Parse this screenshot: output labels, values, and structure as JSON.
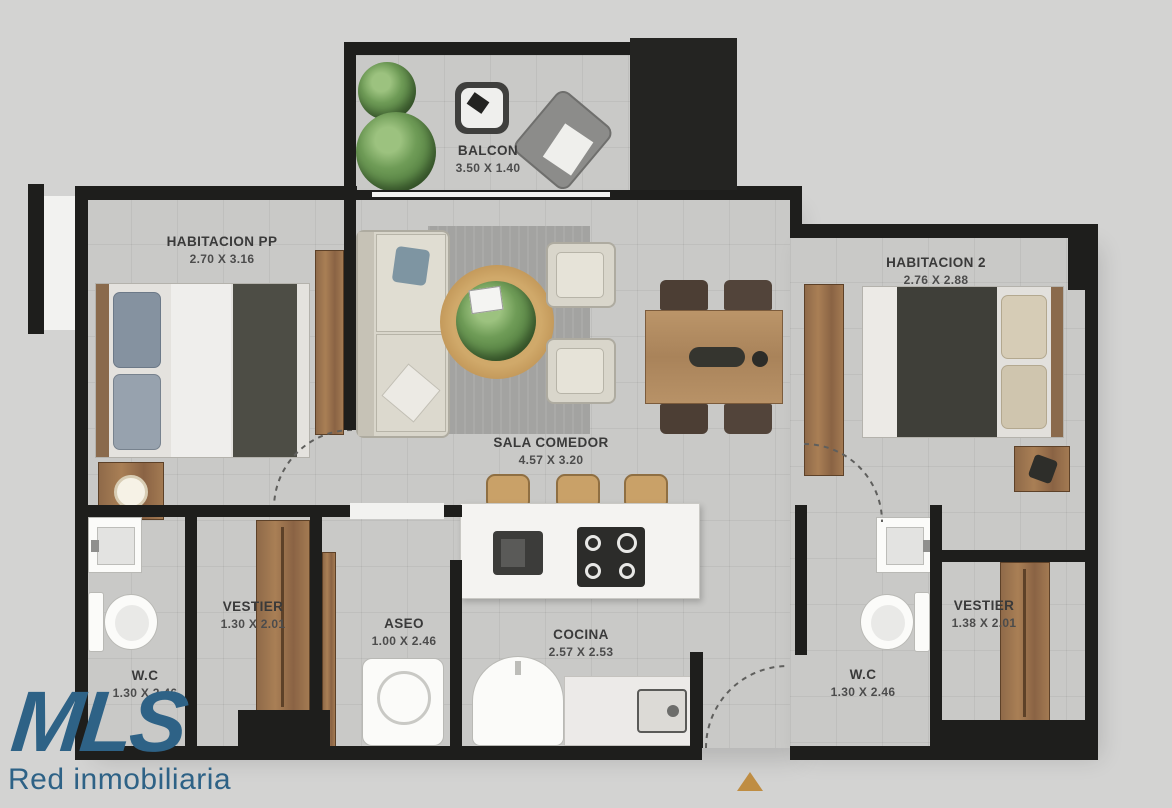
{
  "background": "#d3d3d2",
  "plan": {
    "wall_color": "#1e1e1c",
    "floor_color": "#c9c9c7",
    "accent_wood_color": "#a97f55",
    "rooms": [
      {
        "name": "BALCON",
        "dims": "3.50 X 1.40"
      },
      {
        "name": "HABITACION PP",
        "dims": "2.70 X 3.16"
      },
      {
        "name": "HABITACION 2",
        "dims": "2.76 X 2.88"
      },
      {
        "name": "SALA COMEDOR",
        "dims": "4.57 X 3.20"
      },
      {
        "name": "VESTIER",
        "dims": "1.30 X 2.01"
      },
      {
        "name": "ASEO",
        "dims": "1.00 X 2.46"
      },
      {
        "name": "COCINA",
        "dims": "2.57 X 2.53"
      },
      {
        "name": "W.C",
        "dims": "1.30 X 2.46"
      },
      {
        "name": "W.C",
        "dims": "1.30 X 2.46"
      },
      {
        "name": "VESTIER",
        "dims": "1.38 X 2.01"
      }
    ]
  },
  "logo": {
    "brand": "MLS",
    "tagline": "Red inmobiliaria",
    "color": "#2e6286"
  },
  "entrance_marker": {
    "shape": "triangle-up",
    "color": "#bf8d43"
  }
}
